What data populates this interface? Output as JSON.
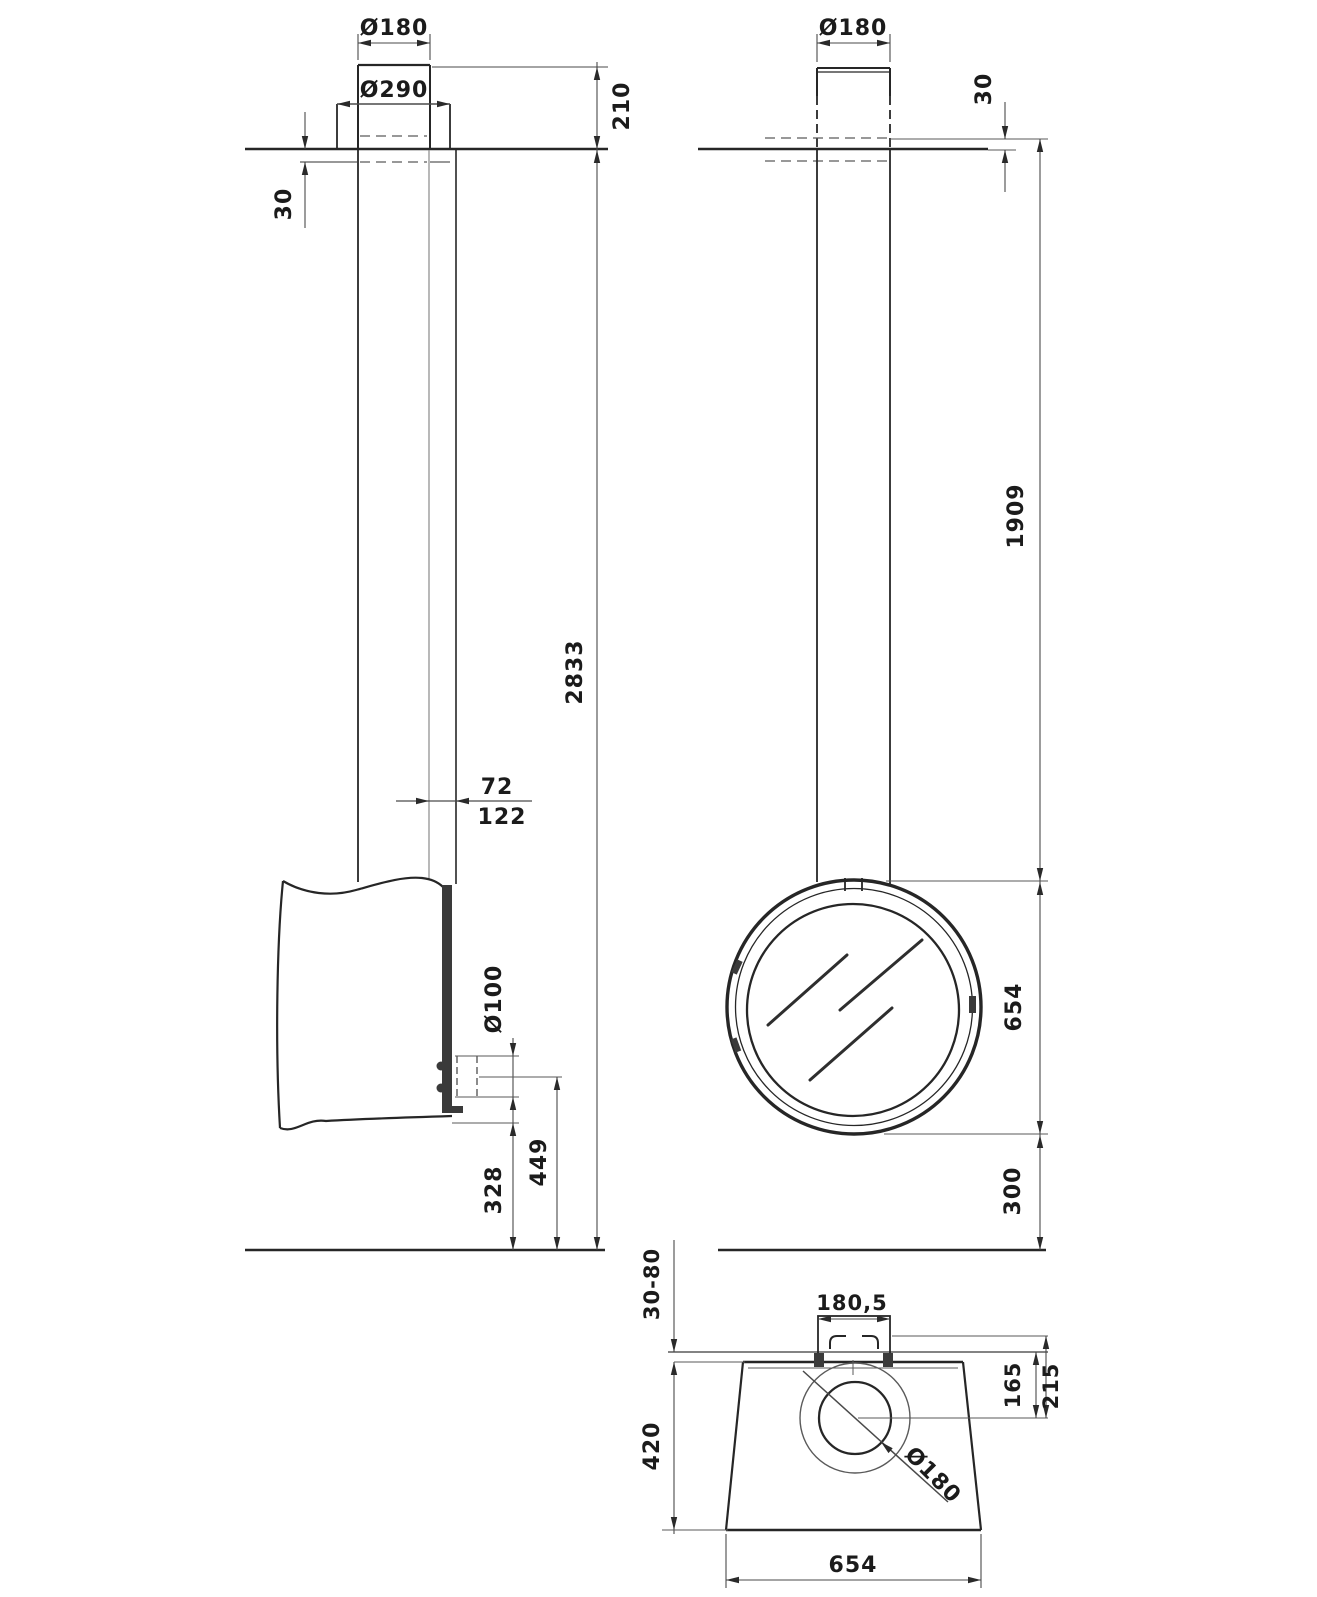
{
  "title": "Suspended rotating fireplace installation drawing",
  "views": {
    "side": {
      "flue_diameter": "Ø180",
      "collar_diameter": "Ø290",
      "above_ceiling_height": "210",
      "collar_below_ceiling": "30",
      "total_height": "2833",
      "flue_offset_front": "72",
      "flue_offset_back": "122",
      "gas_inlet_diameter": "Ø100",
      "gas_inlet_height": "449",
      "body_bottom_height": "328"
    },
    "front": {
      "flue_diameter": "Ø180",
      "ceiling_plate_thickness": "30",
      "flue_length": "1909",
      "body_diameter": "654",
      "body_floor_clearance": "300"
    },
    "plate": {
      "adjust_range": "30-80",
      "bracket_width": "180,5",
      "center_offset_1": "165",
      "center_offset_2": "215",
      "plate_depth": "420",
      "hole_diameter": "Ø180",
      "base_width": "654"
    }
  }
}
